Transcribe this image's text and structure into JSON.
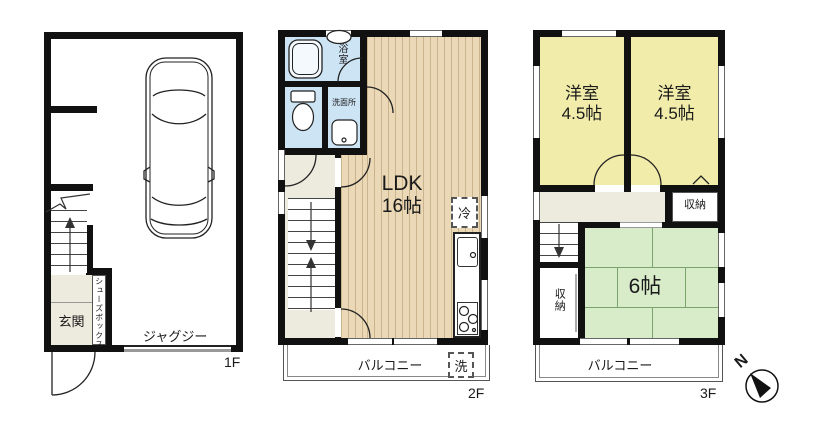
{
  "f1": {
    "label": "1F",
    "entrance": "玄関",
    "shoe_box": "シューズボックス",
    "jacuzzi": "ジャグジー"
  },
  "f2": {
    "label": "2F",
    "bathroom": "浴室",
    "washroom": "洗面所",
    "ldk_name": "LDK",
    "ldk_size": "16帖",
    "fridge": "冷",
    "washer": "洗",
    "balcony": "バルコニー"
  },
  "f3": {
    "label": "3F",
    "western1_name": "洋室",
    "western1_size": "4.5帖",
    "western2_name": "洋室",
    "western2_size": "4.5帖",
    "closet_upper": "収納",
    "closet_lower": "収納",
    "tatami_size": "6帖",
    "balcony": "バルコニー"
  },
  "compass": {
    "north": "N"
  },
  "colors": {
    "wall": "#111111",
    "wood_floor": "#ead8b6",
    "tatami_green": "#d8ecca",
    "room_yellow": "#f2ecab",
    "wet_area_blue": "#cde4f5",
    "hall_beige": "#edeade"
  }
}
